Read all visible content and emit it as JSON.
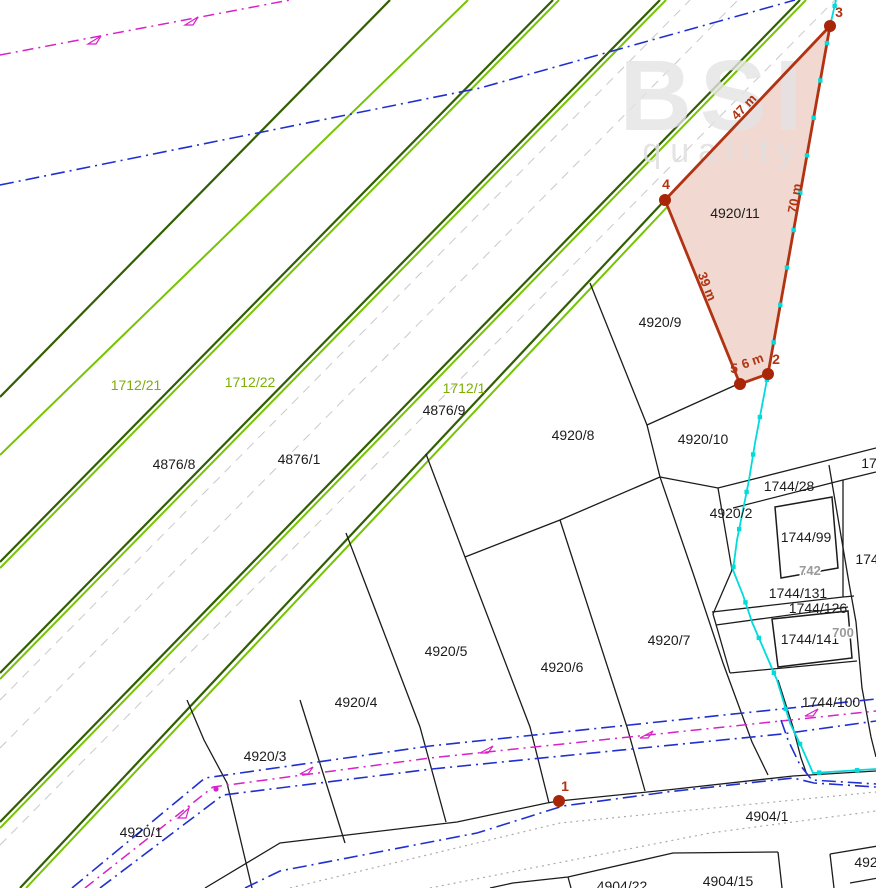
{
  "watermark": {
    "logo": "BSI",
    "word": "quality"
  },
  "parcel_labels": [
    {
      "text": "1712/21",
      "x": 136,
      "y": 390,
      "cls": "lbl-green"
    },
    {
      "text": "1712/22",
      "x": 250,
      "y": 387,
      "cls": "lbl-green"
    },
    {
      "text": "1712/1",
      "x": 464,
      "y": 393,
      "cls": "lbl-green"
    },
    {
      "text": "4876/8",
      "x": 174,
      "y": 469,
      "cls": "lbl-black"
    },
    {
      "text": "4876/1",
      "x": 299,
      "y": 464,
      "cls": "lbl-black"
    },
    {
      "text": "4876/9",
      "x": 444,
      "y": 415,
      "cls": "lbl-black"
    },
    {
      "text": "4920/8",
      "x": 573,
      "y": 440,
      "cls": "lbl-black"
    },
    {
      "text": "4920/9",
      "x": 660,
      "y": 327,
      "cls": "lbl-black"
    },
    {
      "text": "4920/10",
      "x": 703,
      "y": 444,
      "cls": "lbl-black"
    },
    {
      "text": "4920/2",
      "x": 731,
      "y": 518,
      "cls": "lbl-black"
    },
    {
      "text": "4920/11",
      "x": 735,
      "y": 218,
      "cls": "lbl-black"
    },
    {
      "text": "4920/5",
      "x": 446,
      "y": 656,
      "cls": "lbl-black"
    },
    {
      "text": "4920/6",
      "x": 562,
      "y": 672,
      "cls": "lbl-black"
    },
    {
      "text": "4920/7",
      "x": 669,
      "y": 645,
      "cls": "lbl-black"
    },
    {
      "text": "4920/4",
      "x": 356,
      "y": 707,
      "cls": "lbl-black"
    },
    {
      "text": "4920/3",
      "x": 265,
      "y": 761,
      "cls": "lbl-black"
    },
    {
      "text": "4920/1",
      "x": 141,
      "y": 837,
      "cls": "lbl-black"
    },
    {
      "text": "4904/1",
      "x": 767,
      "y": 821,
      "cls": "lbl-black"
    },
    {
      "text": "4904/15",
      "x": 728,
      "y": 886,
      "cls": "lbl-black"
    },
    {
      "text": "4904/22",
      "x": 622,
      "y": 891,
      "cls": "lbl-black"
    },
    {
      "text": "492",
      "x": 866,
      "y": 867,
      "cls": "lbl-black"
    },
    {
      "text": "1744/28",
      "x": 789,
      "y": 491,
      "cls": "lbl-black"
    },
    {
      "text": "1744/99",
      "x": 806,
      "y": 542,
      "cls": "lbl-black"
    },
    {
      "text": "1744/131",
      "x": 798,
      "y": 598,
      "cls": "lbl-black"
    },
    {
      "text": "1744/126",
      "x": 818,
      "y": 613,
      "cls": "lbl-black"
    },
    {
      "text": "1744/141",
      "x": 810,
      "y": 644,
      "cls": "lbl-black"
    },
    {
      "text": "1744/100",
      "x": 831,
      "y": 707,
      "cls": "lbl-black"
    },
    {
      "text": "742",
      "x": 810,
      "y": 575,
      "cls": "lbl-gray"
    },
    {
      "text": "700",
      "x": 843,
      "y": 637,
      "cls": "lbl-gray"
    },
    {
      "text": "17",
      "x": 869,
      "y": 468,
      "cls": "lbl-black"
    },
    {
      "text": "174",
      "x": 867,
      "y": 564,
      "cls": "lbl-black"
    }
  ],
  "highlight": {
    "parcel_number": "4920/11",
    "fill": "#f1d8d0",
    "stroke": "#b13312",
    "vertices": [
      {
        "n": "1",
        "x": 559,
        "y": 801,
        "lx": 565,
        "ly": 791
      },
      {
        "n": "2",
        "x": 768,
        "y": 374,
        "lx": 776,
        "ly": 364
      },
      {
        "n": "3",
        "x": 830,
        "y": 26,
        "lx": 839,
        "ly": 17
      },
      {
        "n": "4",
        "x": 665,
        "y": 200,
        "lx": 666,
        "ly": 189
      },
      {
        "n": "5",
        "x": 740,
        "y": 384,
        "lx": 734,
        "ly": 373
      }
    ],
    "measurements": [
      {
        "text": "47 m",
        "x": 747,
        "y": 110,
        "rot": -46
      },
      {
        "text": "70 m",
        "x": 799,
        "y": 199,
        "rot": -80
      },
      {
        "text": "39 m",
        "x": 703,
        "y": 288,
        "rot": 68
      },
      {
        "text": "6 m",
        "x": 754,
        "y": 365,
        "rot": -20
      }
    ]
  }
}
